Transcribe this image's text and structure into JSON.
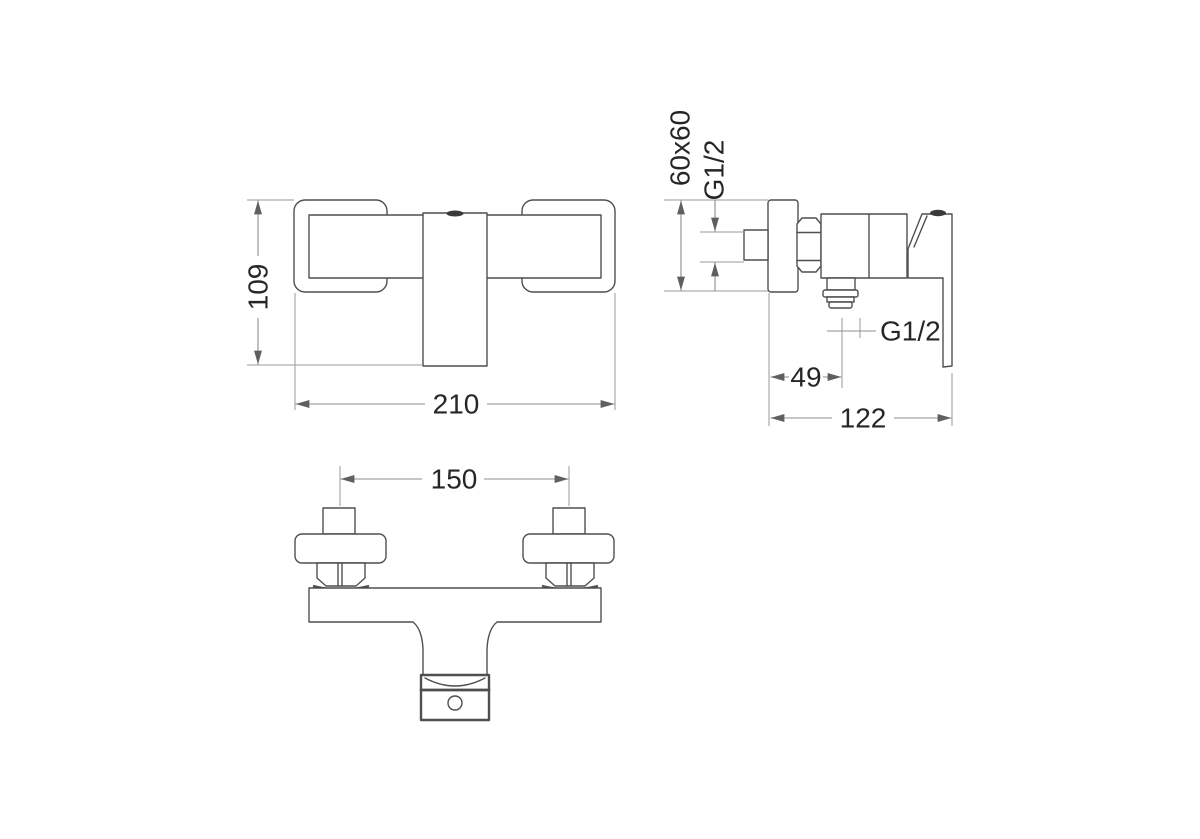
{
  "drawing": {
    "type": "technical-dimension-drawing",
    "subject": "wall-mounted-shower-mixer-tap",
    "views": {
      "front": {
        "height_mm": "109",
        "width_mm": "210"
      },
      "side": {
        "wall_plate": "60x60",
        "inlet_thread": "G1/2",
        "outlet_thread": "G1/2",
        "outlet_offset_mm": "49",
        "depth_mm": "122"
      },
      "bottom": {
        "hole_spacing_mm": "150"
      }
    },
    "colors": {
      "object_line": "#4f4f4f",
      "dimension_line": "#8d8d8d",
      "text": "#262626",
      "background": "#ffffff"
    }
  }
}
